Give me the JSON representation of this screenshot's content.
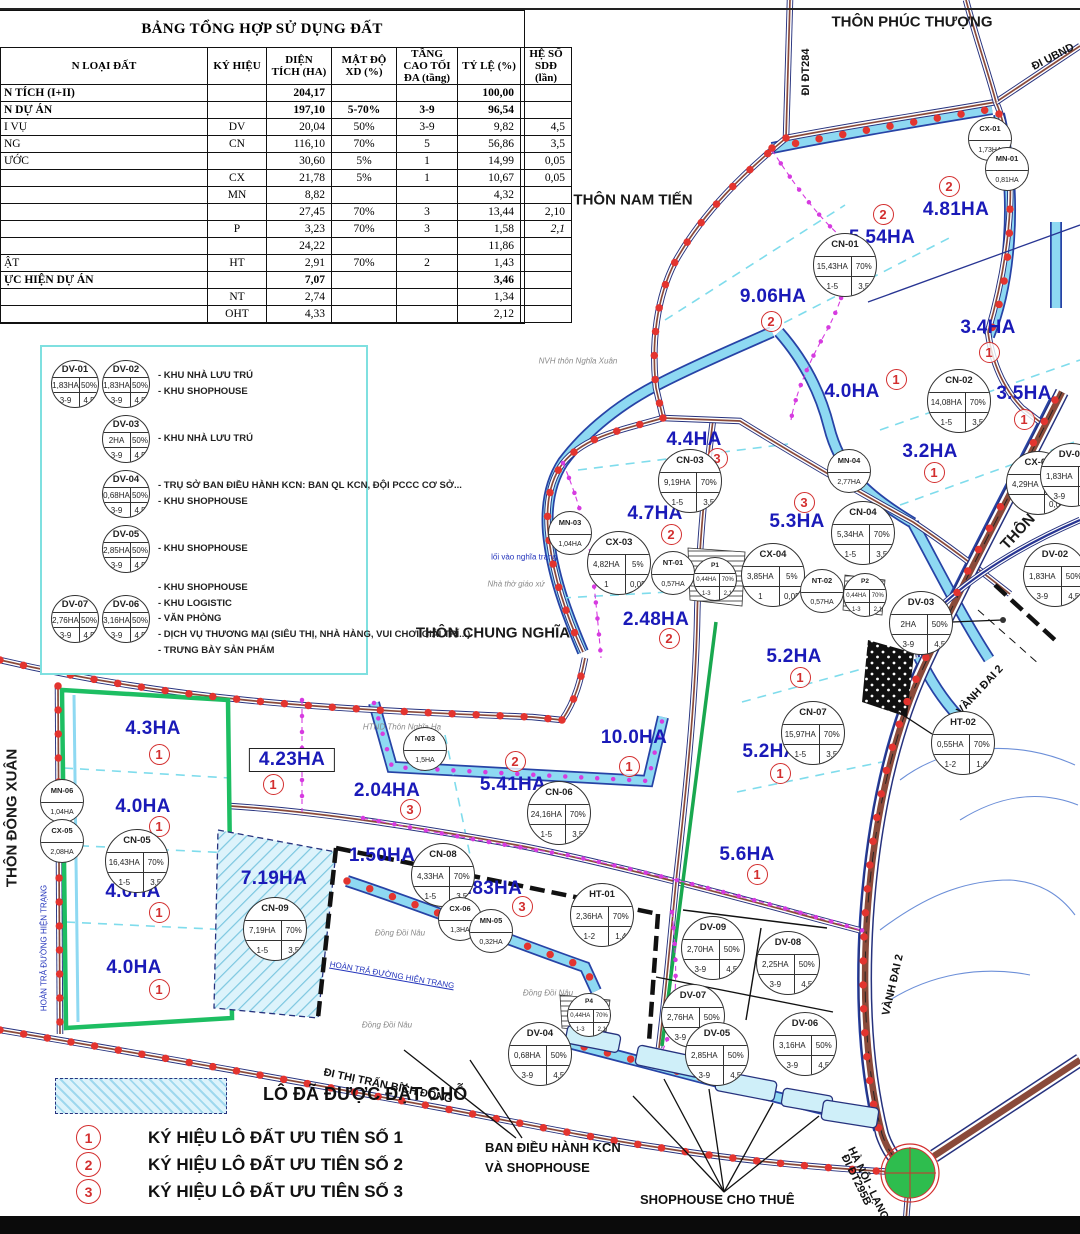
{
  "table": {
    "title": "BẢNG TỔNG HỢP SỬ DỤNG ĐẤT",
    "columns": [
      "N LOẠI ĐẤT",
      "KÝ HIỆU",
      "DIỆN TÍCH (HA)",
      "MẬT ĐỘ XD (%)",
      "TẦNG CAO TỐI ĐA (tầng)",
      "TỶ LỆ (%)",
      "HỆ SỐ SDĐ (lần)"
    ],
    "rows": [
      {
        "name": "N TÍCH (I+II)",
        "kh": "",
        "dt": "204,17",
        "mat": "",
        "tang": "",
        "tyle": "100,00",
        "hs": "",
        "bold": true
      },
      {
        "name": "N DỰ ÁN",
        "kh": "",
        "dt": "197,10",
        "mat": "5-70%",
        "tang": "3-9",
        "tyle": "96,54",
        "hs": "",
        "bold": true
      },
      {
        "name": "I VỤ",
        "kh": "DV",
        "dt": "20,04",
        "mat": "50%",
        "tang": "3-9",
        "tyle": "9,82",
        "hs": "4,5"
      },
      {
        "name": "NG",
        "kh": "CN",
        "dt": "116,10",
        "mat": "70%",
        "tang": "5",
        "tyle": "56,86",
        "hs": "3,5"
      },
      {
        "name": "ƯỚC",
        "kh": "",
        "dt": "30,60",
        "mat": "5%",
        "tang": "1",
        "tyle": "14,99",
        "hs": "0,05"
      },
      {
        "name": "",
        "kh": "CX",
        "dt": "21,78",
        "mat": "5%",
        "tang": "1",
        "tyle": "10,67",
        "hs": "0,05"
      },
      {
        "name": "",
        "kh": "MN",
        "dt": "8,82",
        "mat": "",
        "tang": "",
        "tyle": "4,32",
        "hs": ""
      },
      {
        "name": "",
        "kh": "",
        "dt": "27,45",
        "mat": "70%",
        "tang": "3",
        "tyle": "13,44",
        "hs": "2,10"
      },
      {
        "name": "",
        "kh": "P",
        "dt": "3,23",
        "mat": "70%",
        "tang": "3",
        "tyle": "1,58",
        "hs": "2,1",
        "hs_italic": true
      },
      {
        "name": "",
        "kh": "",
        "dt": "24,22",
        "mat": "",
        "tang": "",
        "tyle": "11,86",
        "hs": ""
      },
      {
        "name": "ẬT",
        "kh": "HT",
        "dt": "2,91",
        "mat": "70%",
        "tang": "2",
        "tyle": "1,43",
        "hs": ""
      },
      {
        "name": "ỰC HIỆN DỰ ÁN",
        "kh": "",
        "dt": "7,07",
        "mat": "",
        "tang": "",
        "tyle": "3,46",
        "hs": "",
        "bold": true
      },
      {
        "name": "",
        "kh": "NT",
        "dt": "2,74",
        "mat": "",
        "tang": "",
        "tyle": "1,34",
        "hs": ""
      },
      {
        "name": "",
        "kh": "OHT",
        "dt": "4,33",
        "mat": "",
        "tang": "",
        "tyle": "2,12",
        "hs": ""
      }
    ]
  },
  "legend_box": {
    "items": [
      {
        "circles": [
          {
            "id": "DV-01",
            "a": "1,83HA",
            "d": "50%",
            "fl": "3-9",
            "c": "4,5"
          },
          {
            "id": "DV-02",
            "a": "1,83HA",
            "d": "50%",
            "fl": "3-9",
            "c": "4,5"
          }
        ],
        "lines": [
          "- KHU NHÀ LƯU TRÚ",
          "- KHU SHOPHOUSE"
        ]
      },
      {
        "circles": [
          {
            "id": "DV-03",
            "a": "2HA",
            "d": "50%",
            "fl": "3-9",
            "c": "4,5"
          }
        ],
        "lines": [
          "- KHU NHÀ LƯU TRÚ"
        ]
      },
      {
        "circles": [
          {
            "id": "DV-04",
            "a": "0,68HA",
            "d": "50%",
            "fl": "3-9",
            "c": "4,5"
          }
        ],
        "lines": [
          "- TRỤ SỞ BAN ĐIỀU HÀNH KCN: BAN QL KCN, ĐỘI PCCC CƠ SỞ...",
          "- KHU SHOPHOUSE"
        ]
      },
      {
        "circles": [
          {
            "id": "DV-05",
            "a": "2,85HA",
            "d": "50%",
            "fl": "3-9",
            "c": "4,5"
          }
        ],
        "lines": [
          "- KHU SHOPHOUSE"
        ]
      },
      {
        "circles": [
          {
            "id": "DV-07",
            "a": "2,76HA",
            "d": "50%",
            "fl": "3-9",
            "c": "4,5"
          },
          {
            "id": "DV-06",
            "a": "3,16HA",
            "d": "50%",
            "fl": "3-9",
            "c": "4,5"
          }
        ],
        "lines": [
          "- KHU SHOPHOUSE",
          "- KHU LOGISTIC",
          "- VĂN PHÒNG",
          "- DỊCH VỤ THƯƠNG MẠI (SIÊU THỊ, NHÀ HÀNG, VUI CHƠI GIẢI TRÍ...)",
          "- TRƯNG BÀY SẢN PHẨM"
        ]
      }
    ]
  },
  "map": {
    "colors": {
      "area_label": "#1A1AB8",
      "priority_red": "#D32F2F",
      "boundary_dots": "#E3342F",
      "water": "#8ED9F2",
      "water_edge": "#2743A6",
      "road_center": "#8A4A3A",
      "green": "#1DBE62",
      "magenta": "#D63BE0"
    },
    "villages": [
      {
        "t": "THÔN PHÚC THƯỢNG",
        "x": 912,
        "y": 22,
        "r": 0
      },
      {
        "t": "THÔN NAM TIẾN",
        "x": 633,
        "y": 200,
        "r": 0
      },
      {
        "t": "THÔN CHUNG NGHĨA",
        "x": 493,
        "y": 633,
        "r": 0
      },
      {
        "t": "THÔN ĐÔNG XUÂN",
        "x": 12,
        "y": 818,
        "r": -90
      },
      {
        "t": "THÔN TRẠI TÂY",
        "x": 1043,
        "y": 505,
        "r": -47
      }
    ],
    "road_labels": [
      {
        "t": "ĐI ĐT284",
        "x": 806,
        "y": 72,
        "r": -90
      },
      {
        "t": "ĐI UBND",
        "x": 1053,
        "y": 57,
        "r": -27
      },
      {
        "t": "VÀNH ĐAI 2",
        "x": 980,
        "y": 690,
        "r": -47
      },
      {
        "t": "VÀNH ĐAI 2",
        "x": 893,
        "y": 985,
        "r": -77
      },
      {
        "t": "ĐI THỊ TRẤN BÍCH ĐỘNG",
        "x": 388,
        "y": 1086,
        "r": 12
      },
      {
        "t": "ĐI ĐT295B",
        "x": 856,
        "y": 1180,
        "r": 64
      },
      {
        "t": "HÀ NỘI - LẠNG SƠN",
        "x": 874,
        "y": 1196,
        "r": 64
      }
    ],
    "small_labels": [
      {
        "t": "NVH thôn Nghĩa Xuân",
        "x": 578,
        "y": 361,
        "r": 0,
        "c": "gray"
      },
      {
        "t": "lối vào nghĩa trang",
        "x": 524,
        "y": 557,
        "r": 0,
        "c": "blue"
      },
      {
        "t": "Nhà thờ giáo xứ",
        "x": 516,
        "y": 584,
        "r": 0,
        "c": "gray"
      },
      {
        "t": "HTND Thôn Nghĩa Hạ",
        "x": 402,
        "y": 727,
        "r": 0,
        "c": "gray"
      },
      {
        "t": "Đồng Đồi Nâu",
        "x": 400,
        "y": 933,
        "r": 0,
        "c": "gray"
      },
      {
        "t": "Đồng Đồi Nâu",
        "x": 548,
        "y": 993,
        "r": 0,
        "c": "gray"
      },
      {
        "t": "Đồng Đồi Nâu",
        "x": 387,
        "y": 1025,
        "r": 0,
        "c": "gray"
      },
      {
        "t": "HOÀN TRẢ ĐƯỜNG HIỆN TRẠNG",
        "x": 392,
        "y": 975,
        "r": 10,
        "c": "blue",
        "u": true
      },
      {
        "t": "HOÀN TRẢ ĐƯỜNG HIỆN TRẠNG",
        "x": 44,
        "y": 948,
        "r": -90,
        "c": "blue"
      }
    ],
    "area_labels": [
      {
        "t": "9.06HA",
        "x": 773,
        "y": 297,
        "p": "2",
        "px": 770,
        "py": 320
      },
      {
        "t": "5.54HA",
        "x": 882,
        "y": 238,
        "p": "2",
        "px": 882,
        "py": 213
      },
      {
        "t": "4.81HA",
        "x": 956,
        "y": 210,
        "p": "2",
        "px": 948,
        "py": 185
      },
      {
        "t": "3.4HA",
        "x": 988,
        "y": 328,
        "p": "1",
        "px": 988,
        "py": 351
      },
      {
        "t": "4.0HA",
        "x": 852,
        "y": 392,
        "p": "1",
        "px": 895,
        "py": 378
      },
      {
        "t": "3.5HA",
        "x": 1024,
        "y": 394,
        "p": "1",
        "px": 1023,
        "py": 418
      },
      {
        "t": "3.2HA",
        "x": 930,
        "y": 452,
        "p": "1",
        "px": 933,
        "py": 471
      },
      {
        "t": "4.4HA",
        "x": 694,
        "y": 440,
        "p": "3",
        "px": 716,
        "py": 457
      },
      {
        "t": "4.7HA",
        "x": 655,
        "y": 514,
        "p": "2",
        "px": 670,
        "py": 533
      },
      {
        "t": "5.3HA",
        "x": 797,
        "y": 522,
        "p": "3",
        "px": 803,
        "py": 501
      },
      {
        "t": "2.48HA",
        "x": 656,
        "y": 620,
        "p": "2",
        "px": 668,
        "py": 637
      },
      {
        "t": "5.2HA",
        "x": 794,
        "y": 657,
        "p": "1",
        "px": 799,
        "py": 676
      },
      {
        "t": "5.2HA",
        "x": 770,
        "y": 752,
        "p": "1",
        "px": 779,
        "py": 772
      },
      {
        "t": "10.0HA",
        "x": 634,
        "y": 738,
        "p": "1",
        "px": 628,
        "py": 765
      },
      {
        "t": "5.6HA",
        "x": 747,
        "y": 855,
        "p": "1",
        "px": 756,
        "py": 873
      },
      {
        "t": "5.41HA",
        "x": 513,
        "y": 785,
        "p": "2",
        "px": 514,
        "py": 760
      },
      {
        "t": "2.04HA",
        "x": 387,
        "y": 791,
        "p": "3",
        "px": 409,
        "py": 808
      },
      {
        "t": "4.23HA",
        "x": 292,
        "y": 760,
        "p": "1",
        "px": 272,
        "py": 783,
        "boxed": true
      },
      {
        "t": "4.3HA",
        "x": 153,
        "y": 729,
        "p": "1",
        "px": 158,
        "py": 753
      },
      {
        "t": "4.0HA",
        "x": 143,
        "y": 807,
        "p": "1",
        "px": 158,
        "py": 825
      },
      {
        "t": "4.0HA",
        "x": 133,
        "y": 892,
        "p": "1",
        "px": 158,
        "py": 911
      },
      {
        "t": "4.0HA",
        "x": 134,
        "y": 968,
        "p": "1",
        "px": 158,
        "py": 988
      },
      {
        "t": "7.19HA",
        "x": 274,
        "y": 879
      },
      {
        "t": "1.50HA",
        "x": 382,
        "y": 856
      },
      {
        "t": "2.83HA",
        "x": 489,
        "y": 889,
        "p": "3",
        "px": 521,
        "py": 905
      }
    ],
    "lots": [
      {
        "id": "CX-01",
        "x": 989,
        "y": 138,
        "k": "m",
        "a": "1,73HA"
      },
      {
        "id": "MN-01",
        "x": 1006,
        "y": 168,
        "k": "m",
        "a": "0,81HA"
      },
      {
        "id": "CN-01",
        "x": 844,
        "y": 264,
        "k": "f",
        "a": "15,43HA",
        "d": "70%",
        "fl": "1-5",
        "c": "3,5"
      },
      {
        "id": "CN-02",
        "x": 958,
        "y": 400,
        "k": "f",
        "a": "14,08HA",
        "d": "70%",
        "fl": "1-5",
        "c": "3,5"
      },
      {
        "id": "CN-03",
        "x": 689,
        "y": 480,
        "k": "f",
        "a": "9,19HA",
        "d": "70%",
        "fl": "1-5",
        "c": "3,5"
      },
      {
        "id": "MN-04",
        "x": 848,
        "y": 470,
        "k": "m",
        "a": "2,77HA"
      },
      {
        "id": "CN-04",
        "x": 862,
        "y": 532,
        "k": "f",
        "a": "5,34HA",
        "d": "70%",
        "fl": "1-5",
        "c": "3,5"
      },
      {
        "id": "CX-02",
        "x": 1037,
        "y": 482,
        "k": "f",
        "a": "4,29HA",
        "d": "5%",
        "fl": "",
        "c": "0,05"
      },
      {
        "id": "MN-03",
        "x": 569,
        "y": 532,
        "k": "m",
        "a": "1,04HA"
      },
      {
        "id": "CX-03",
        "x": 618,
        "y": 562,
        "k": "f",
        "a": "4,82HA",
        "d": "5%",
        "fl": "1",
        "c": "0,05"
      },
      {
        "id": "NT-01",
        "x": 672,
        "y": 572,
        "k": "m",
        "a": "0,57HA"
      },
      {
        "id": "P1",
        "x": 714,
        "y": 578,
        "k": "fs",
        "a": "0,44HA",
        "d": "70%",
        "fl": "1-3",
        "c": "2,1"
      },
      {
        "id": "CX-04",
        "x": 772,
        "y": 574,
        "k": "f",
        "a": "3,85HA",
        "d": "5%",
        "fl": "1",
        "c": "0,05"
      },
      {
        "id": "NT-02",
        "x": 821,
        "y": 590,
        "k": "m",
        "a": "0,57HA"
      },
      {
        "id": "P2",
        "x": 864,
        "y": 594,
        "k": "fs",
        "a": "0,44HA",
        "d": "70%",
        "fl": "1-3",
        "c": "2,1"
      },
      {
        "id": "DV-03",
        "x": 920,
        "y": 622,
        "k": "f",
        "a": "2HA",
        "d": "50%",
        "fl": "3-9",
        "c": "4,5"
      },
      {
        "id": "DV-01",
        "x": 1071,
        "y": 474,
        "k": "f",
        "a": "1,83HA",
        "d": "50%",
        "fl": "3-9",
        "c": "4,5"
      },
      {
        "id": "DV-02",
        "x": 1054,
        "y": 574,
        "k": "f",
        "a": "1,83HA",
        "d": "50%",
        "fl": "3-9",
        "c": "4,5"
      },
      {
        "id": "HT-02",
        "x": 962,
        "y": 742,
        "k": "f",
        "a": "0,55HA",
        "d": "70%",
        "fl": "1-2",
        "c": "1,4"
      },
      {
        "id": "CN-07",
        "x": 812,
        "y": 732,
        "k": "f",
        "a": "15,97HA",
        "d": "70%",
        "fl": "1-5",
        "c": "3,5"
      },
      {
        "id": "CN-06",
        "x": 558,
        "y": 812,
        "k": "f",
        "a": "24,16HA",
        "d": "70%",
        "fl": "1-5",
        "c": "3,5"
      },
      {
        "id": "NT-03",
        "x": 424,
        "y": 748,
        "k": "m",
        "a": "1,5HA"
      },
      {
        "id": "CN-05",
        "x": 136,
        "y": 860,
        "k": "f",
        "a": "16,43HA",
        "d": "70%",
        "fl": "1-5",
        "c": "3,5"
      },
      {
        "id": "MN-06",
        "x": 61,
        "y": 800,
        "k": "m",
        "a": "1,04HA"
      },
      {
        "id": "CX-05",
        "x": 61,
        "y": 840,
        "k": "m",
        "a": "2,08HA"
      },
      {
        "id": "CN-09",
        "x": 274,
        "y": 928,
        "k": "f",
        "a": "7,19HA",
        "d": "70%",
        "fl": "1-5",
        "c": "3,5"
      },
      {
        "id": "CN-08",
        "x": 442,
        "y": 874,
        "k": "f",
        "a": "4,33HA",
        "d": "70%",
        "fl": "1-5",
        "c": "3,5"
      },
      {
        "id": "CX-06",
        "x": 459,
        "y": 918,
        "k": "m",
        "a": "1,3HA"
      },
      {
        "id": "MN-05",
        "x": 490,
        "y": 930,
        "k": "m",
        "a": "0,32HA"
      },
      {
        "id": "HT-01",
        "x": 601,
        "y": 914,
        "k": "f",
        "a": "2,36HA",
        "d": "70%",
        "fl": "1-2",
        "c": "1,4"
      },
      {
        "id": "P4",
        "x": 588,
        "y": 1014,
        "k": "fs",
        "a": "0,44HA",
        "d": "70%",
        "fl": "1-3",
        "c": "2,1"
      },
      {
        "id": "DV-09",
        "x": 712,
        "y": 947,
        "k": "f",
        "a": "2,70HA",
        "d": "50%",
        "fl": "3-9",
        "c": "4,5"
      },
      {
        "id": "DV-08",
        "x": 787,
        "y": 962,
        "k": "f",
        "a": "2,25HA",
        "d": "50%",
        "fl": "3-9",
        "c": "4,5"
      },
      {
        "id": "DV-07",
        "x": 692,
        "y": 1015,
        "k": "f",
        "a": "2,76HA",
        "d": "50%",
        "fl": "3-9",
        "c": "4,5"
      },
      {
        "id": "DV-05",
        "x": 716,
        "y": 1053,
        "k": "f",
        "a": "2,85HA",
        "d": "50%",
        "fl": "3-9",
        "c": "4,5"
      },
      {
        "id": "DV-06",
        "x": 804,
        "y": 1043,
        "k": "f",
        "a": "3,16HA",
        "d": "50%",
        "fl": "3-9",
        "c": "4,5"
      },
      {
        "id": "DV-04",
        "x": 539,
        "y": 1053,
        "k": "f",
        "a": "0,68HA",
        "d": "50%",
        "fl": "3-9",
        "c": "4,5"
      }
    ],
    "legend_bottom": {
      "reserved": "LÔ ĐÃ ĐƯỢC ĐẶT CHỖ",
      "priorities": [
        {
          "n": "1",
          "t": "KÝ HIỆU LÔ ĐẤT ƯU TIÊN SỐ 1"
        },
        {
          "n": "2",
          "t": "KÝ HIỆU LÔ ĐẤT ƯU TIÊN SỐ 2"
        },
        {
          "n": "3",
          "t": "KÝ HIỆU LÔ ĐẤT ƯU TIÊN SỐ 3"
        }
      ]
    },
    "annotations": {
      "ban_line1": "BAN ĐIỀU HÀNH KCN",
      "ban_line2": "VÀ SHOPHOUSE",
      "shophouse": "SHOPHOUSE CHO THUÊ"
    }
  }
}
